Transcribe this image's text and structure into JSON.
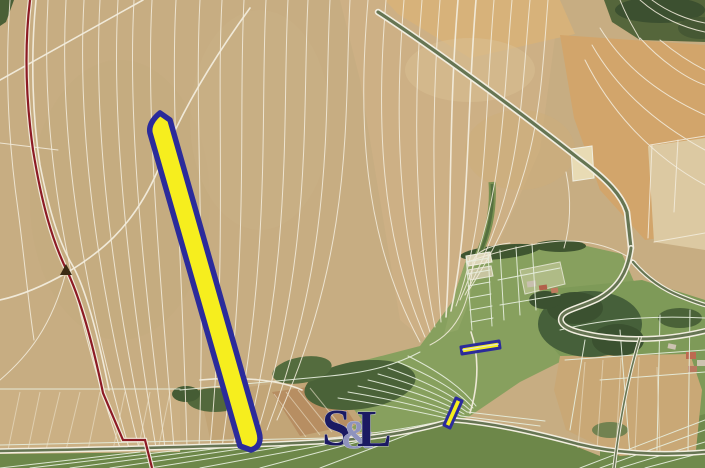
{
  "watermark": {
    "part_s": "S",
    "part_amp": "&",
    "part_l": "L"
  },
  "colors": {
    "parcel_highlight_fill": "#f6ee1e",
    "parcel_highlight_outline": "#2b2b9b",
    "district_boundary_red": "#8c1a24",
    "watermark_navy": "#1b1a62",
    "watermark_ampersand": "#8f93bd",
    "cadastral_line": "#f2ecdc",
    "valley_line": "#e6eedd"
  }
}
